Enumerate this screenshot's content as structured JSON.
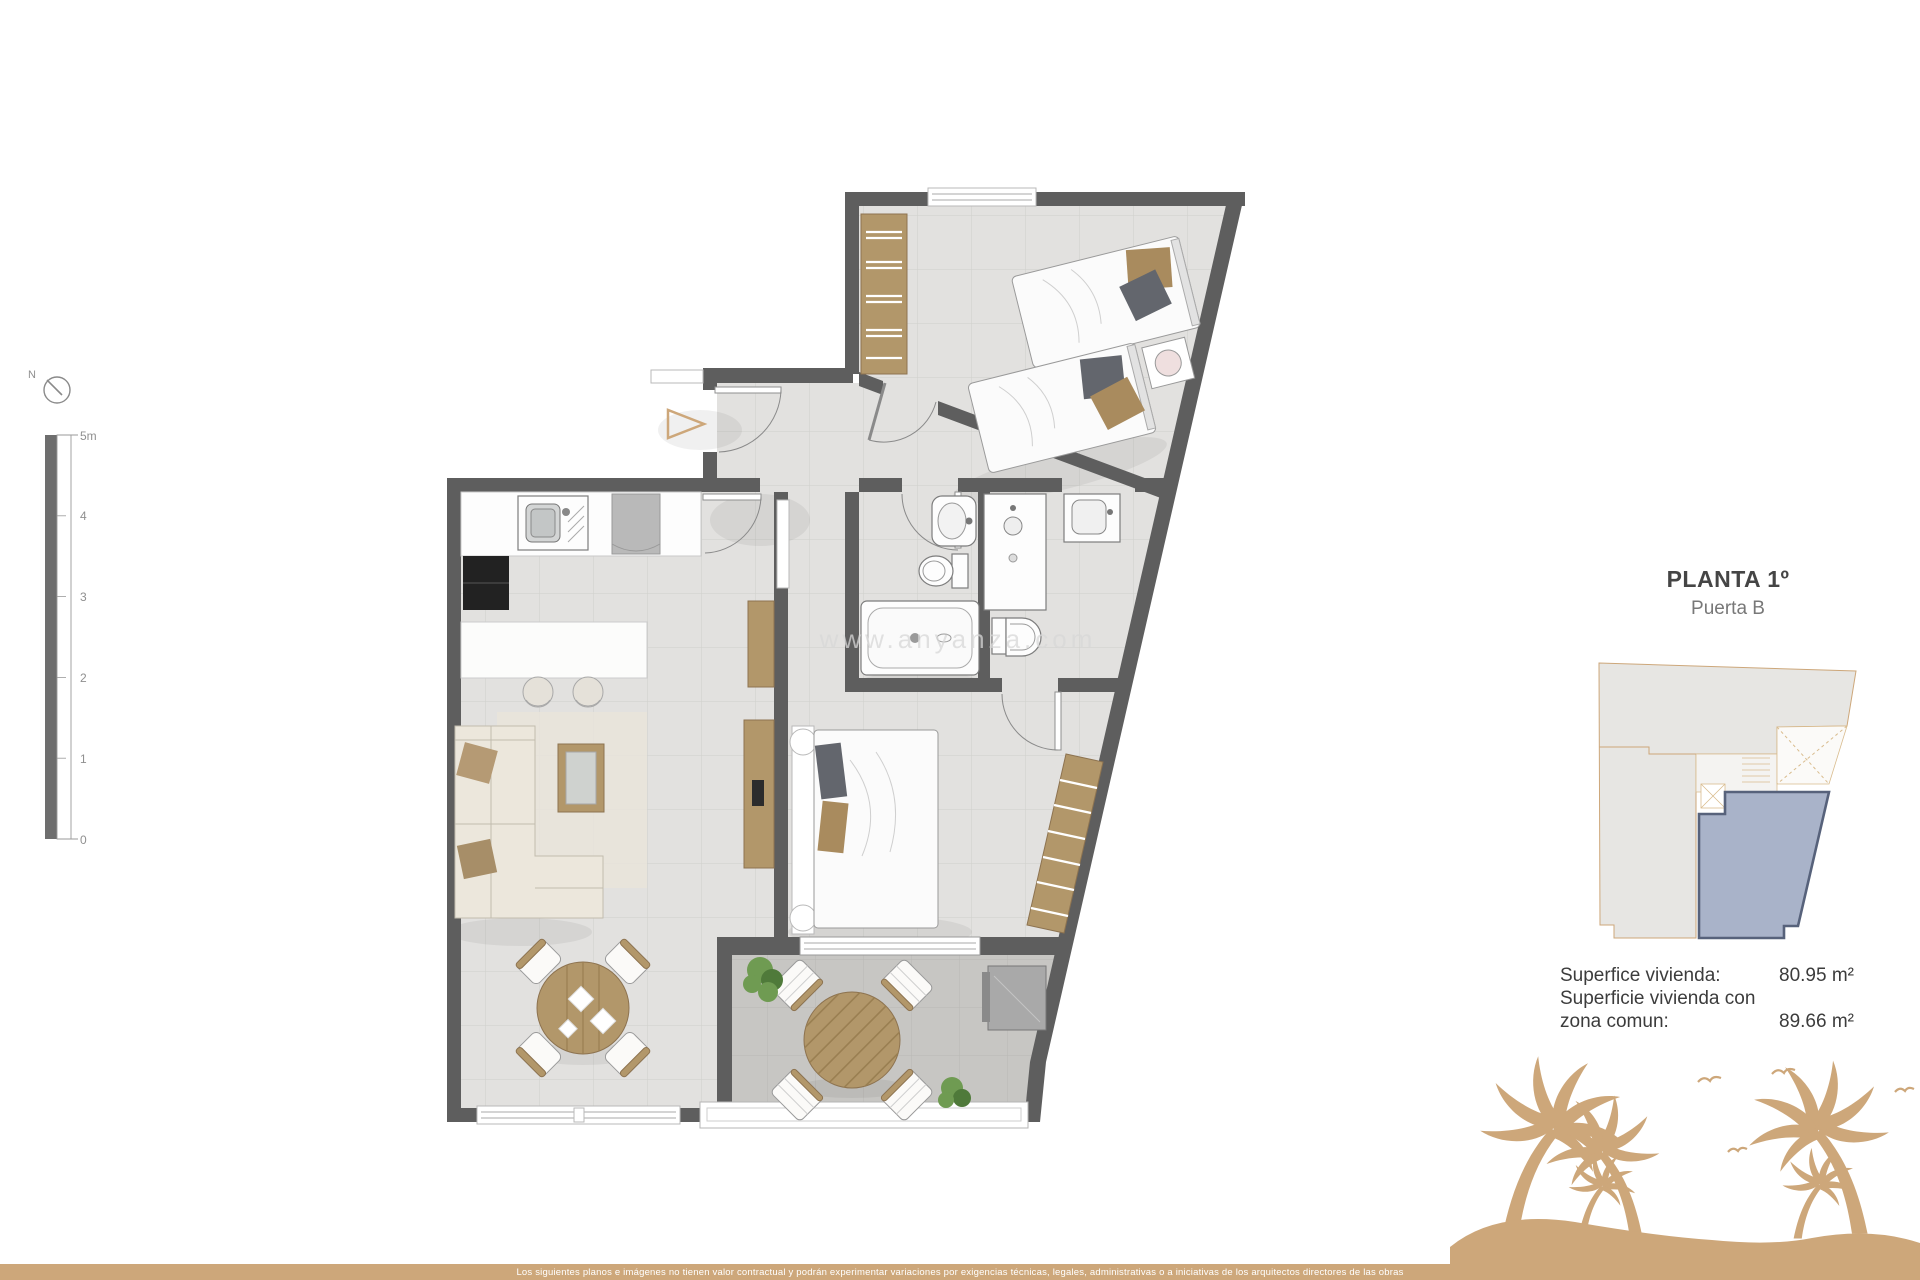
{
  "header": {
    "title": "PLANTA 1º",
    "subtitle": "Puerta B"
  },
  "areas": {
    "line1_label": "Superfice vivienda:",
    "line1_value": "80.95 m²",
    "line2_label": "Superficie vivienda con",
    "line3_label": "zona comun:",
    "line3_value": "89.66 m²"
  },
  "scalebar": {
    "ticks": [
      "5m",
      "4",
      "3",
      "2",
      "1",
      "0"
    ]
  },
  "compass": {
    "label": "N"
  },
  "watermark": {
    "text": "www.anyanza.com"
  },
  "footer": {
    "disclaimer": "Los siguientes planos e imágenes no tienen valor contractual y podrán experimentar variaciones por exigencias técnicas, legales, administrativas o a iniciativas de los arquitectos directores de las obras"
  },
  "colors": {
    "wall": "#5e5e5e",
    "floor": "#e2e1df",
    "floorLine": "#cbcac6",
    "terrace": "#c7c6c3",
    "wood": "#b2976a",
    "woodDark": "#8d7350",
    "cream": "#ece7dc",
    "accent": "#cda77a",
    "blueFill": "#a9b3c9",
    "blueStroke": "#57627b",
    "textDark": "#454545",
    "textMid": "#787878",
    "textLight": "#8f8f8f"
  }
}
